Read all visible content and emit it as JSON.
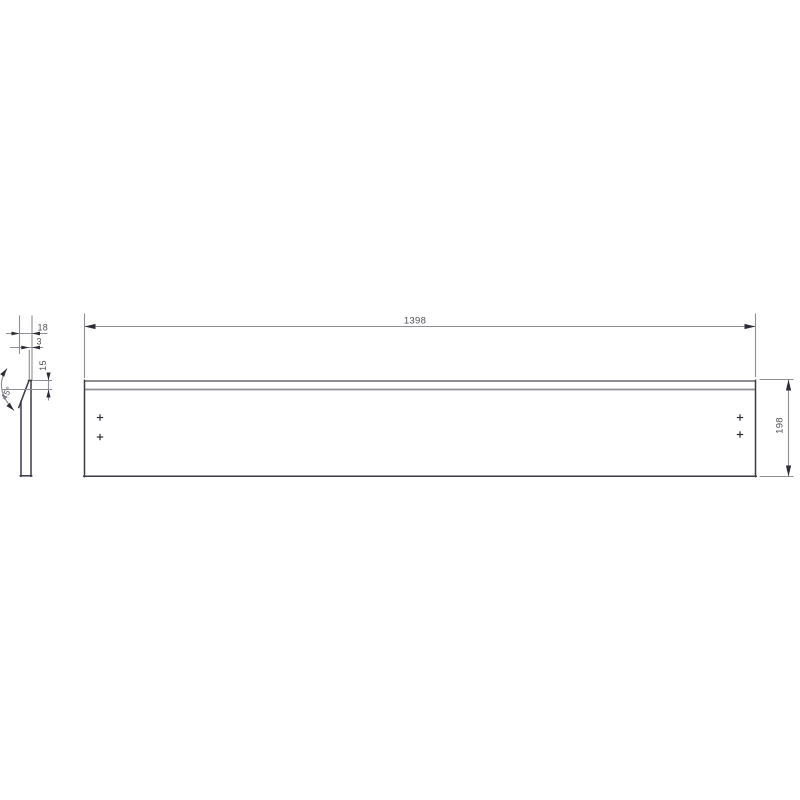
{
  "labels": {
    "length": "1398",
    "height": "198",
    "thickness": "18",
    "top_thickness": "3",
    "chamfer_height": "15",
    "chamfer_angle": "45°"
  },
  "colors": {
    "outline": "#3b3b43",
    "dimension": "#8e8e96",
    "arrow": "#2d2d35",
    "text": "#50505a",
    "background": "#ffffff"
  },
  "hole_marks": {
    "count": 4
  }
}
